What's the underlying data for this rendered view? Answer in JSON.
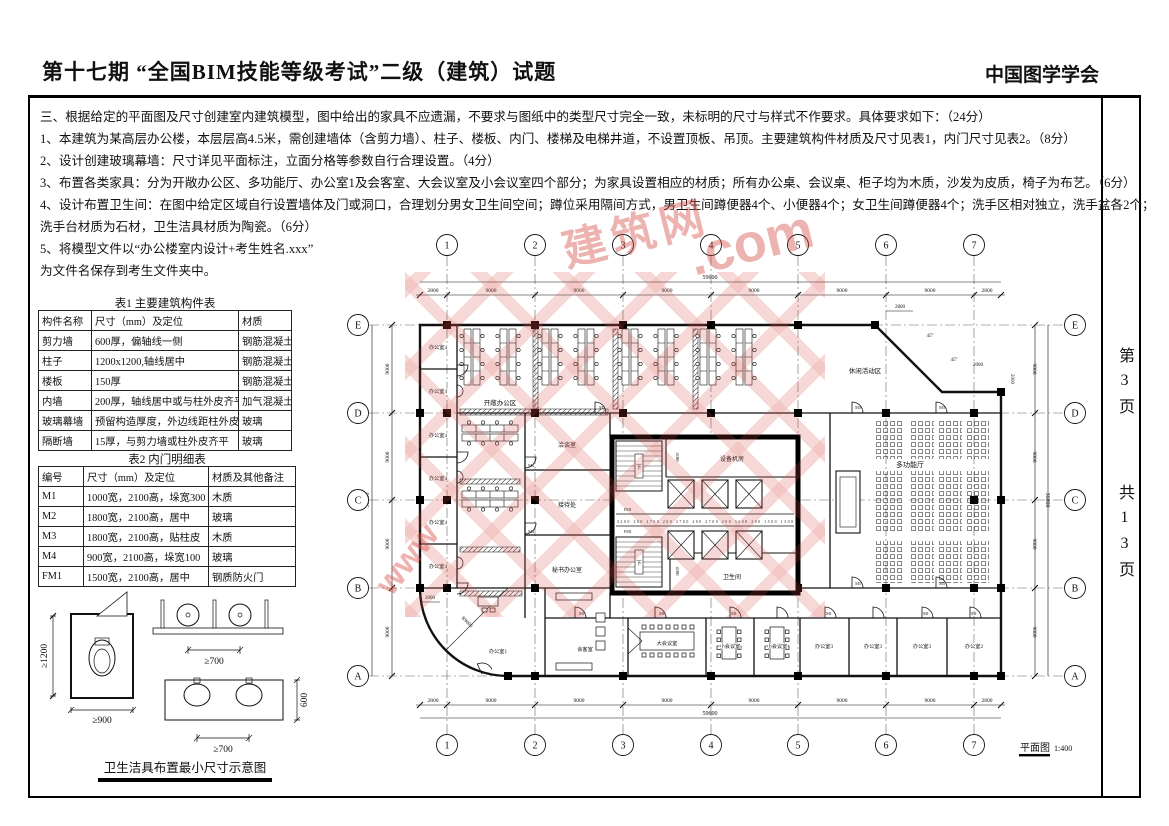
{
  "header": {
    "title": "第十七期 “全国BIM技能等级考试”二级（建筑）试题",
    "org": "中国图学学会"
  },
  "page_info": {
    "current": "第3页",
    "total": "共13页"
  },
  "instructions": {
    "lines": [
      "三、根据给定的平面图及尺寸创建室内建筑模型，图中给出的家具不应遗漏，不要求与图纸中的类型尺寸完全一致，未标明的尺寸与样式不作要求。具体要求如下：（24分）",
      "1、本建筑为某高层办公楼，本层层高4.5米，需创建墙体（含剪力墙）、柱子、楼板、内门、楼梯及电梯井道，不设置顶板、吊顶。主要建筑构件材质及尺寸见表1，内门尺寸见表2。（8分）",
      "2、设计创建玻璃幕墙：尺寸详见平面标注，立面分格等参数自行合理设置。（4分）",
      "3、布置各类家具：分为开敞办公区、多功能厅、办公室1及会客室、大会议室及小会议室四个部分；为家具设置相应的材质；所有办公桌、会议桌、柜子均为木质，沙发为皮质，椅子为布艺。（6分）",
      "4、设计布置卫生间：在图中给定区域自行设置墙体及门或洞口，合理划分男女卫生间空间；蹲位采用隔间方式，男卫生间蹲便器4个、小便器4个；女卫生间蹲便器4个；洗手区相对独立，洗手盆各2个；",
      "洗手台材质为石材，卫生洁具材质为陶瓷。（6分）",
      "5、将模型文件以“办公楼室内设计+考生姓名.xxx”",
      "为文件名保存到考生文件夹中。"
    ]
  },
  "table1": {
    "caption": "表1 主要建筑构件表",
    "headers": [
      "构件名称",
      "尺寸（mm）及定位",
      "材质"
    ],
    "rows": [
      [
        "剪力墙",
        "600厚，偏轴线一侧",
        "钢筋混凝土"
      ],
      [
        "柱子",
        "1200x1200,轴线居中",
        "钢筋混凝土"
      ],
      [
        "楼板",
        "150厚",
        "钢筋混凝土"
      ],
      [
        "内墙",
        "200厚，轴线居中或与柱外皮齐平",
        "加气混凝土砌块"
      ],
      [
        "玻璃幕墙",
        "预留构造厚度，外边线距柱外皮200",
        "玻璃"
      ],
      [
        "隔断墙",
        "15厚，与剪力墙或柱外皮齐平",
        "玻璃"
      ]
    ]
  },
  "table2": {
    "caption": "表2 内门明细表",
    "headers": [
      "编号",
      "尺寸（mm）及定位",
      "材质及其他备注"
    ],
    "rows": [
      [
        "M1",
        "1000宽，2100高，垛宽300",
        "木质"
      ],
      [
        "M2",
        "1800宽，2100高，居中",
        "玻璃"
      ],
      [
        "M3",
        "1800宽，2100高，贴柱皮",
        "木质"
      ],
      [
        "M4",
        "900宽，2100高，垛宽100",
        "玻璃"
      ],
      [
        "FM1",
        "1500宽，2100高，居中",
        "钢质防火门"
      ]
    ]
  },
  "sanitary": {
    "caption": "卫生洁具布置最小尺寸示意图",
    "stall_h": "≥1200",
    "stall_w": "≥900",
    "gap700": "≥700",
    "depth600": "600"
  },
  "plan": {
    "title": "平面图",
    "scale": "1:400",
    "grid_cols": [
      "1",
      "2",
      "3",
      "4",
      "5",
      "6",
      "7"
    ],
    "grid_rows": [
      "E",
      "D",
      "C",
      "B",
      "A"
    ],
    "dims": {
      "d2800": "2800",
      "d9000": "9000",
      "d59600": "59600",
      "d36000": "36000",
      "d2000": "2000",
      "a45": "45°",
      "r9000": "R9000"
    },
    "rooms": {
      "office4": "办公室4",
      "open_office": "开敞办公区",
      "talk": "洽谈室",
      "reception": "接待处",
      "secretary": "秘书办公室",
      "leisure": "休闲活动区",
      "hall": "多功能厅",
      "office1": "办公室1",
      "guest": "会客室",
      "meeting_l": "大会议室",
      "meeting_s": "小会议室",
      "office3": "办公室3",
      "office2": "办公室2",
      "equipment": "设备机房",
      "toilet": "卫生间"
    },
    "doors": {
      "m1": "M1",
      "m2": "M2",
      "m3": "M3",
      "m4": "M4",
      "fm1": "FM1"
    },
    "core": {
      "down": "下",
      "dims": "3200 200 2700 200 2700 200 2700 200 3600 200 1500 1300",
      "v4100": "4100"
    }
  },
  "watermark": {
    "f1": "www",
    "f2": "建筑网",
    "f3": ".com"
  }
}
